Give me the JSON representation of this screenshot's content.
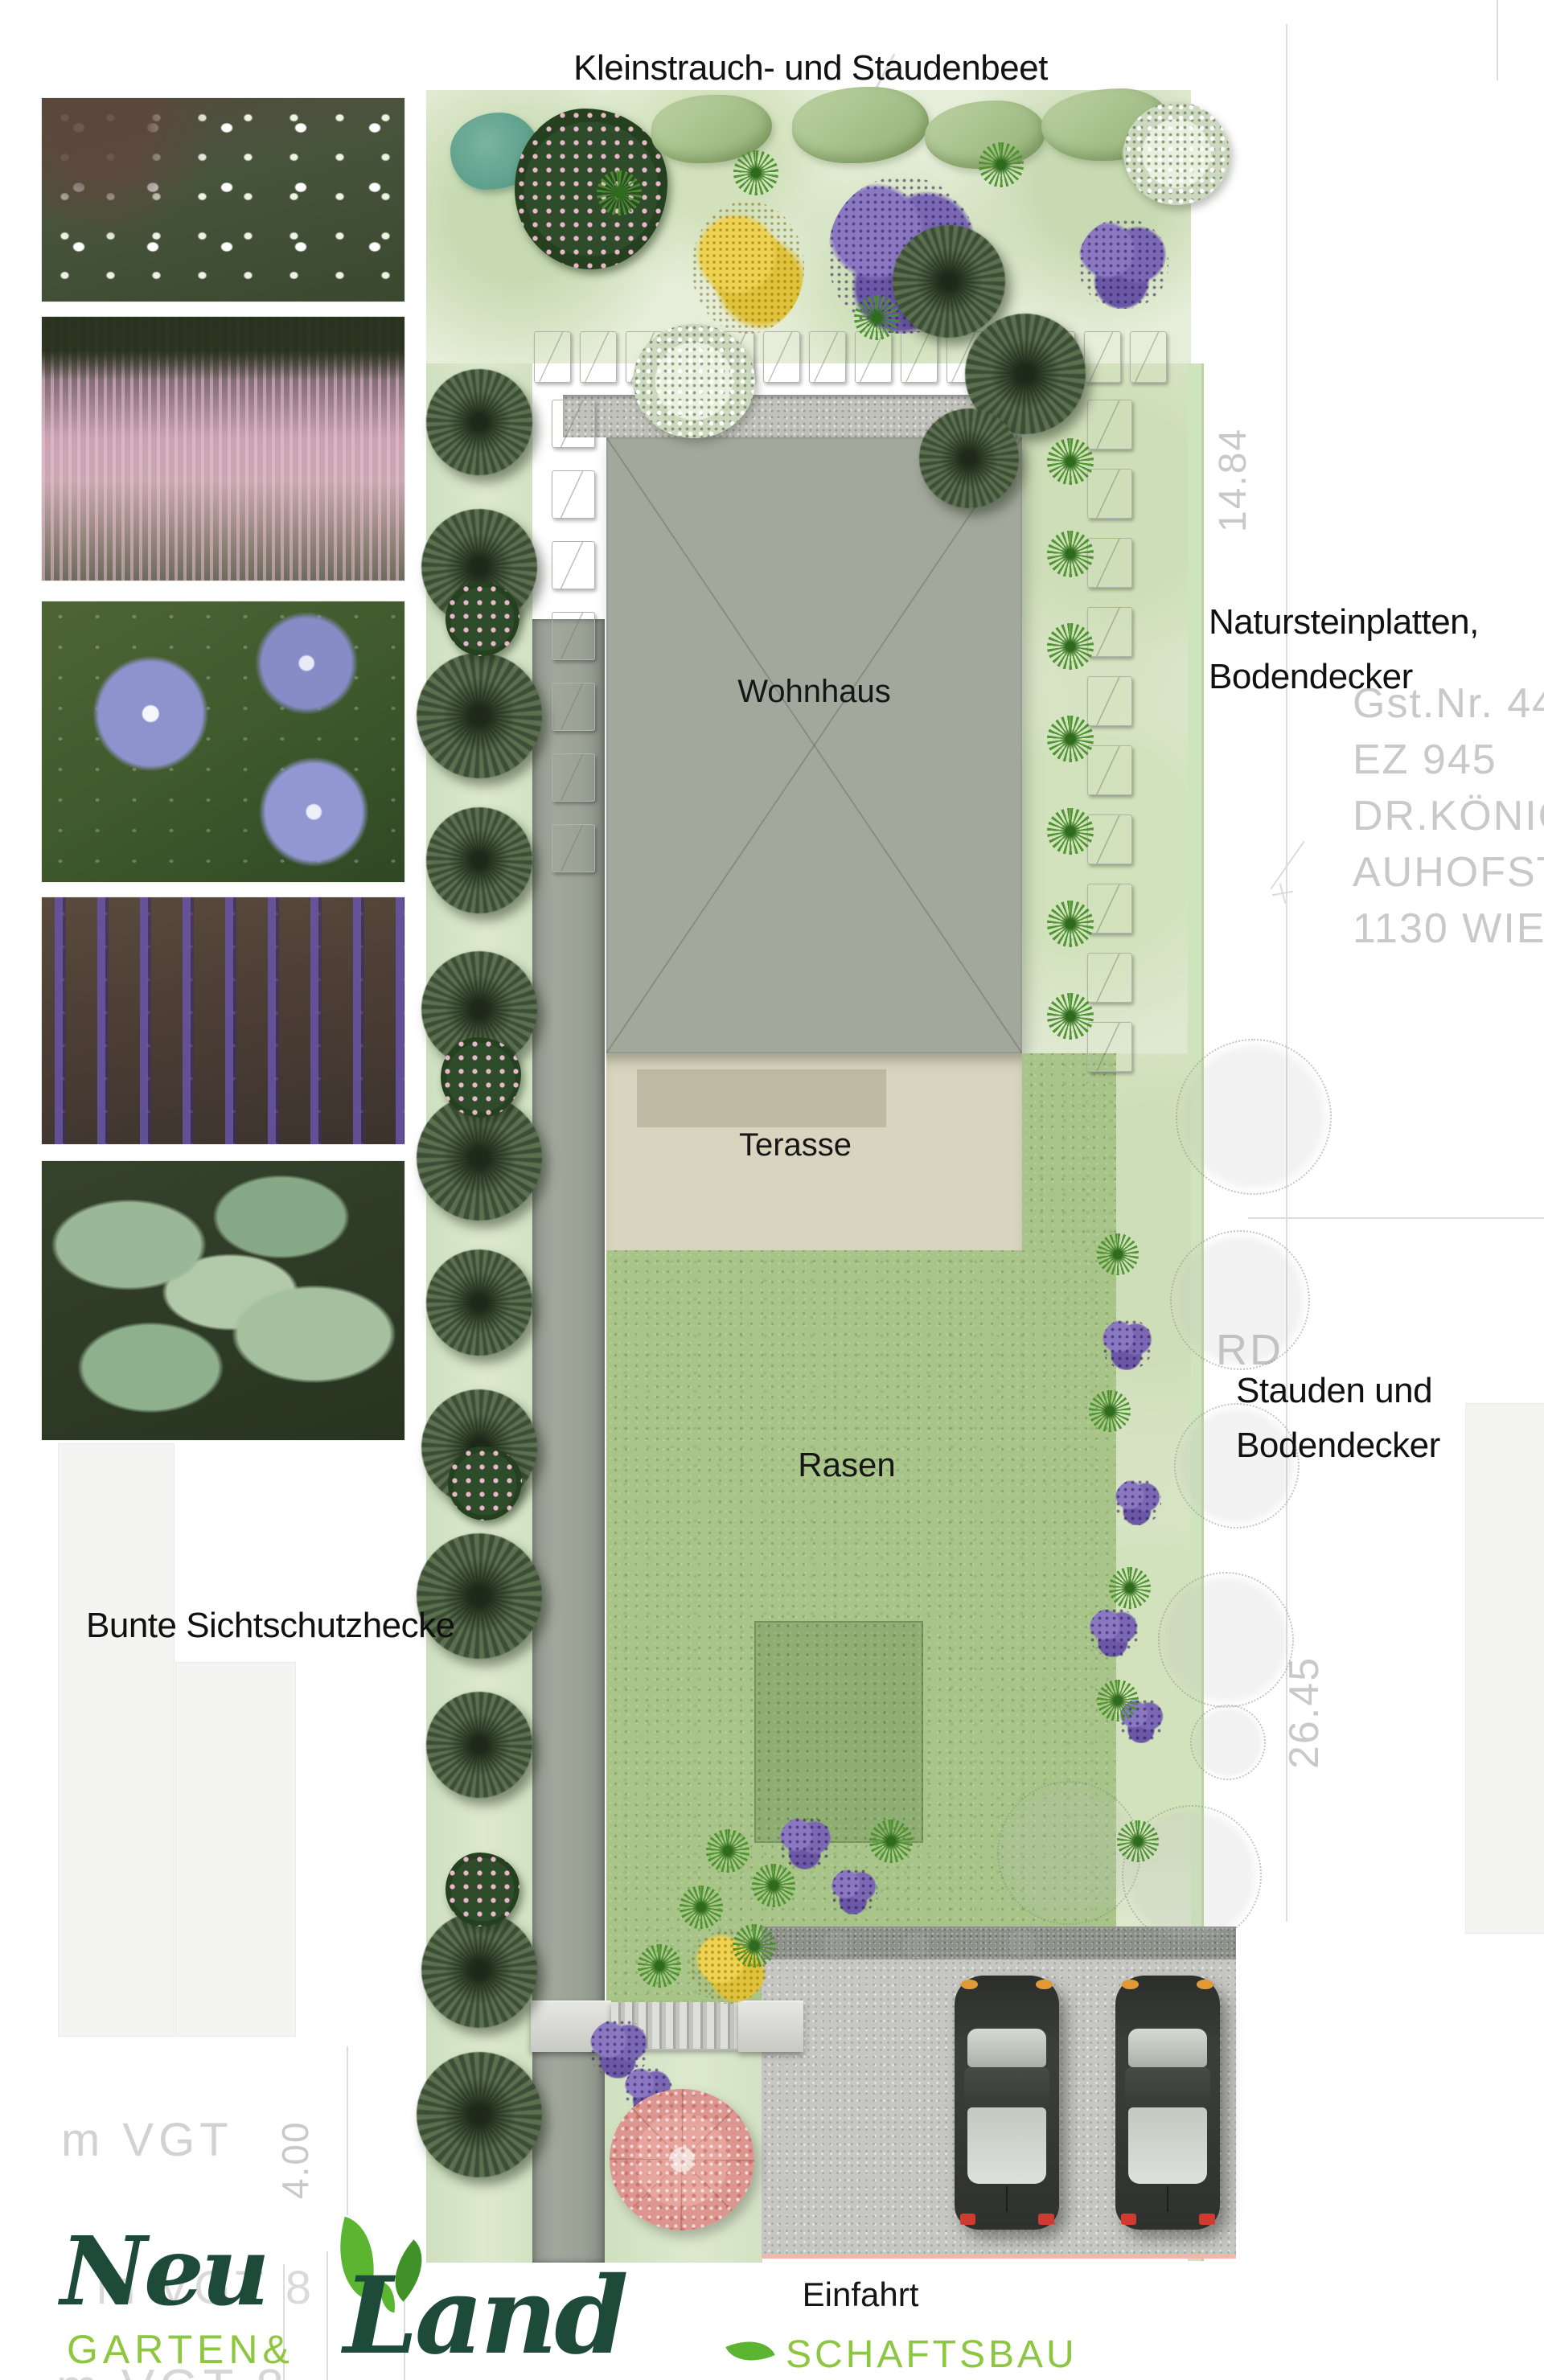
{
  "labels": {
    "bed_title": "Kleinstrauch- und Staudenbeet",
    "house": "Wohnhaus",
    "terrace": "Terasse",
    "lawn": "Rasen",
    "driveway": "Einfahrt",
    "hedge": "Bunte Sichtschutzhecke",
    "stone_area": [
      "Natursteinplatten,",
      "Bodendecker"
    ],
    "perennial_area": [
      "Stauden und",
      "Bodendecker"
    ]
  },
  "survey": {
    "parcel_number": "Gst.Nr. 44",
    "land_register": "EZ 945",
    "owner": "DR.KÖNIG",
    "street": "AUHOFST",
    "city": "1130 WIEN",
    "dim_side_upper": "14.84",
    "dim_side_lower": "26.45",
    "dim_bottom_left": "4.00",
    "grid_text": "m VGT",
    "grid_fragment_mid": "m VGT 8",
    "grid_fragment_bottom": "m VGT 8",
    "direction_fragment": "RD"
  },
  "logo": {
    "script_top": "Neu",
    "script_bottom": "Land",
    "caps_left": "GARTEN&",
    "caps_right": "SCHAFTSBAU",
    "color_dark": "#1d4a39",
    "color_light": "#8dc63f"
  },
  "photos": {
    "subjects": [
      "white-flower-perennials",
      "pink-astilbe",
      "blue-periwinkle",
      "purple-ajuga",
      "hosta-foliage"
    ]
  },
  "colors": {
    "house": "#a2a89c",
    "terrace": "#d8d4bf",
    "lawn": "#a8c489",
    "path": "#9aa195",
    "driveway_gravel": "#c6c6c3",
    "bed_green": "#e6eed9",
    "survey_gray": "#c9c9c9",
    "boundary_pink": "#f3b6ac"
  }
}
